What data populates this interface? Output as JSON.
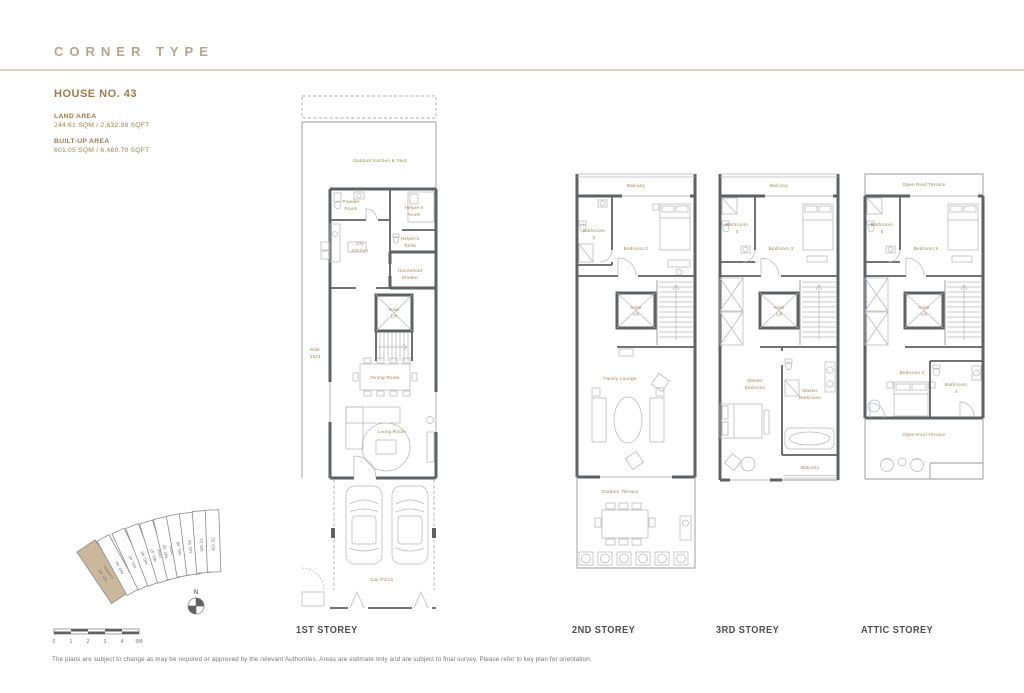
{
  "header": {
    "title": "CORNER TYPE"
  },
  "house": {
    "name": "HOUSE NO. 43",
    "land_area_label": "LAND AREA",
    "land_area_value": "244.61 SQM / 2,632.98 SQFT",
    "built_up_label": "BUILT-UP AREA",
    "built_up_value": "601.05 SQM / 6,469.70 SQFT"
  },
  "plans": {
    "first": {
      "caption": "1ST STOREY",
      "rooms": {
        "outdoor_kitchen_yard": "Outdoor Kitchen & Yard",
        "powder_room": [
          "Powder",
          "Room"
        ],
        "helpers_room": [
          "Helper's",
          "Room"
        ],
        "helpers_toilet": [
          "Helper's",
          "Toilet"
        ],
        "dry_kitchen": [
          "Dry",
          "Kitchen"
        ],
        "household_shelter": [
          "Household",
          "Shelter"
        ],
        "home_lift": [
          "Home",
          "Lift"
        ],
        "side_yard": [
          "Side",
          "Yard"
        ],
        "dining_room": "Dining Room",
        "living_room": "Living Room",
        "car_porch": "Car Porch"
      }
    },
    "second": {
      "caption": "2ND STOREY",
      "rooms": {
        "balcony": "Balcony",
        "bathroom_2": [
          "Bathroom",
          "2"
        ],
        "bedroom_2": "Bedroom 2",
        "home_lift": [
          "Home",
          "Lift"
        ],
        "family_lounge": "Family Lounge",
        "outdoor_terrace": "Outdoor Terrace"
      }
    },
    "third": {
      "caption": "3RD STOREY",
      "rooms": {
        "balcony": "Balcony",
        "bathroom_3": [
          "Bathroom",
          "3"
        ],
        "bedroom_3": "Bedroom 3",
        "home_lift": [
          "Home",
          "Lift"
        ],
        "master_bedroom": [
          "Master",
          "Bedroom"
        ],
        "master_bathroom": [
          "Master",
          "Bathroom"
        ],
        "balcony_rear": "Balcony"
      }
    },
    "attic": {
      "caption": "ATTIC STOREY",
      "rooms": {
        "open_roof_terrace": "Open Roof Terrace",
        "bathroom_5": [
          "Bathroom",
          "5"
        ],
        "bedroom_5": "Bedroom 5",
        "home_lift": [
          "Home",
          "Lift"
        ],
        "bedroom_4": "Bedroom 4",
        "bathroom_4": [
          "Bathroom",
          "4"
        ],
        "open_roof_terrace_rear": "Open Roof Terrace"
      }
    }
  },
  "key_plan": {
    "north_label": "N",
    "lots": [
      {
        "no": "NO. 43",
        "note": "(CORNER)",
        "highlight": true
      },
      {
        "no": "NO. 44",
        "note": ""
      },
      {
        "no": "NO. 45",
        "note": ""
      },
      {
        "no": "NO. 46",
        "note": ""
      },
      {
        "no": "NO. 47",
        "note": "(PRM)"
      },
      {
        "no": "NO. 48",
        "note": "(PRM)"
      },
      {
        "no": "NO. 49",
        "note": ""
      },
      {
        "no": "NO. 50",
        "note": ""
      },
      {
        "no": "NO. 51",
        "note": ""
      },
      {
        "no": "NO. 52",
        "note": ""
      }
    ]
  },
  "scale_bar": {
    "ticks": [
      "0",
      "1",
      "2",
      "3",
      "4",
      "5M"
    ]
  },
  "footer": {
    "disclaimer": "The plans are subject to change as may be required or approved by the relevant Authorities. Areas are estimate only and are subject to final survey. Please refer to key plan for orientation."
  },
  "colors": {
    "accent_gold": "#9c7c49",
    "wall_gray": "#5f6163",
    "highlight_tan": "#cbb79c"
  }
}
